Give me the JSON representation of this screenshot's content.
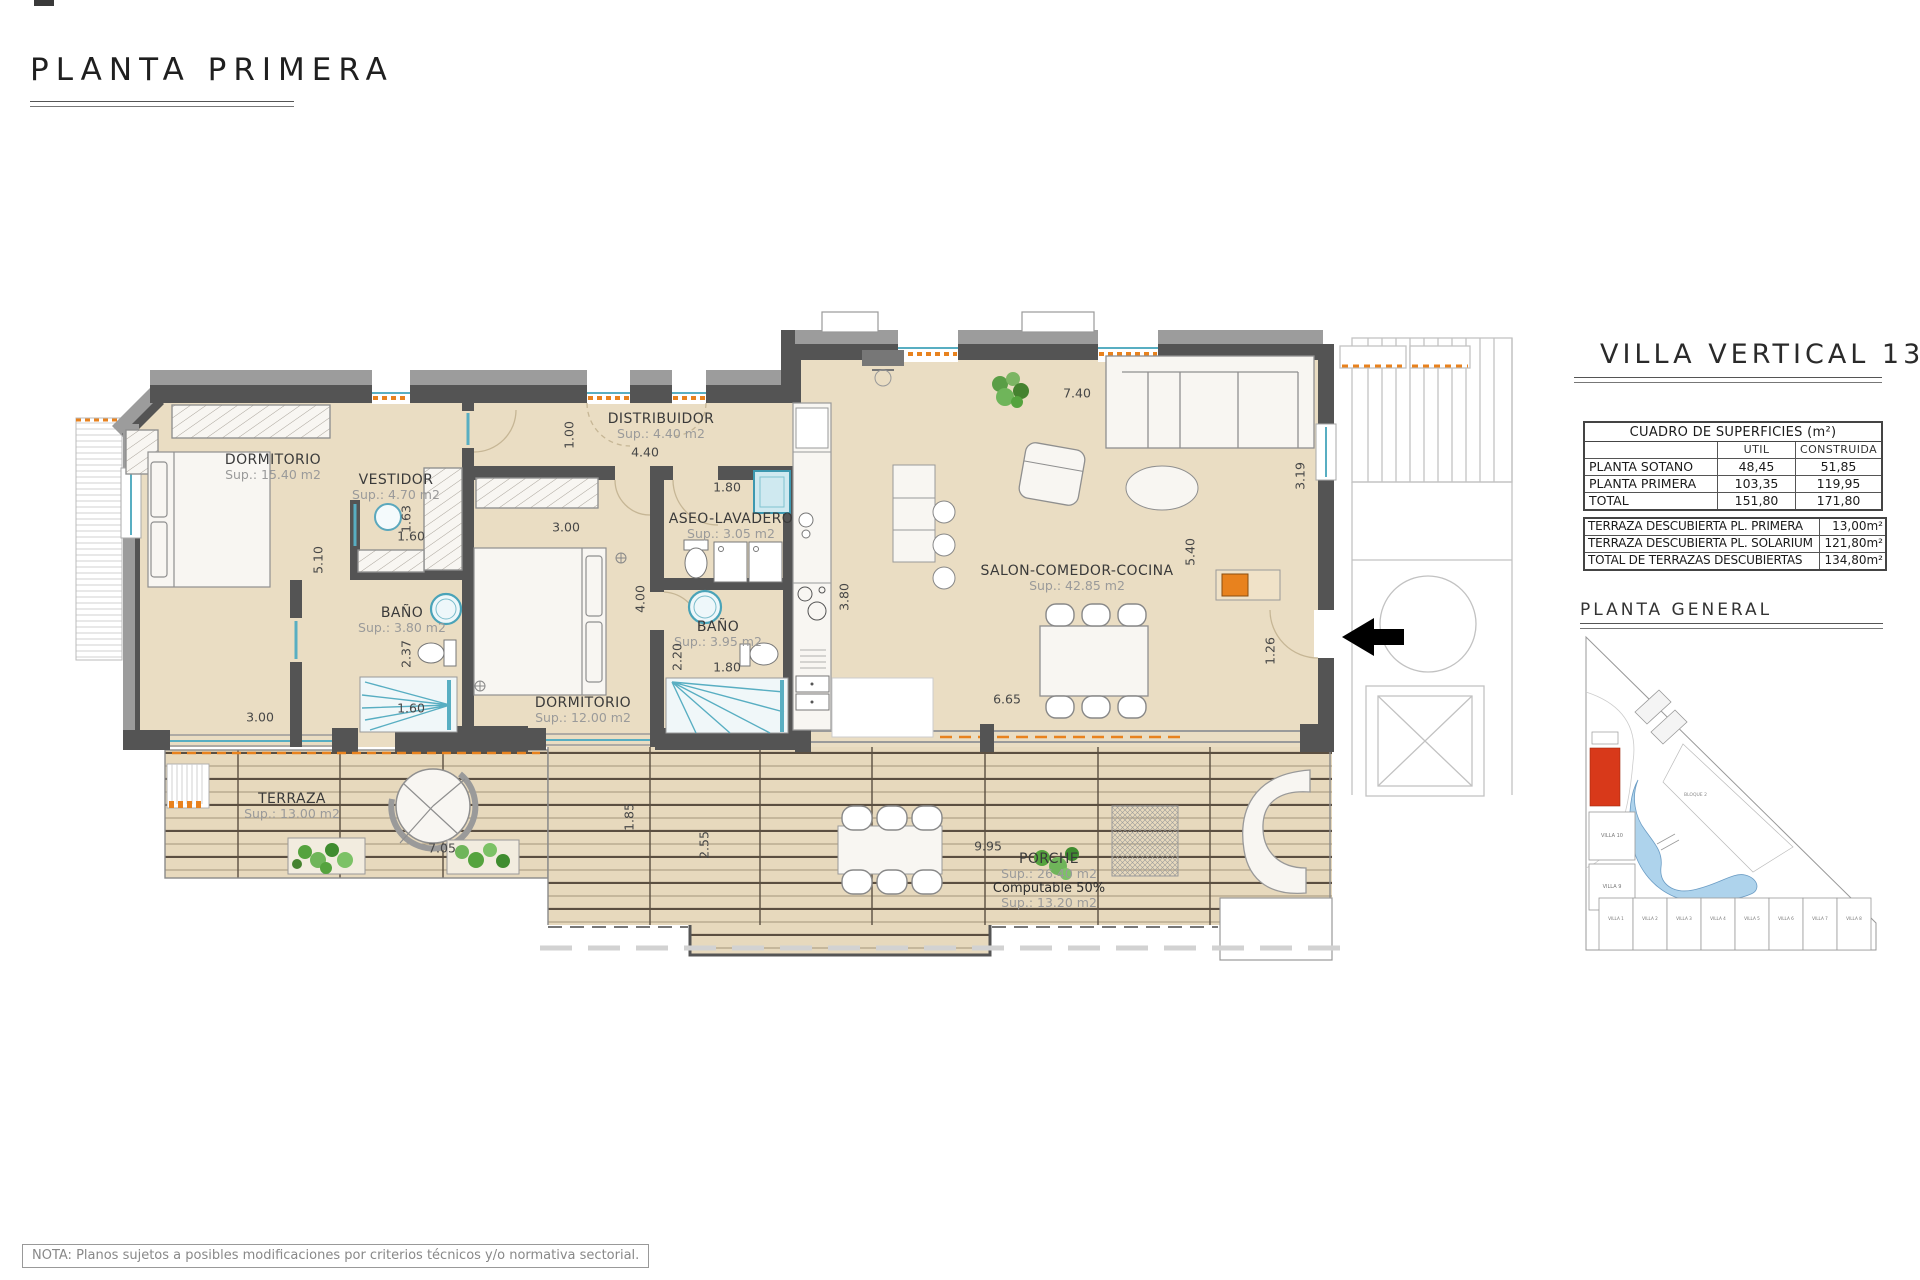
{
  "title": "PLANTA PRIMERA",
  "note": "NOTA: Planos sujetos a posibles modificaciones por criterios técnicos y/o normativa sectorial.",
  "panel": {
    "heading": "VILLA VERTICAL 13",
    "surface_table": {
      "caption": "CUADRO DE SUPERFICIES (m²)",
      "columns": [
        "",
        "UTIL",
        "CONSTRUIDA"
      ],
      "rows": [
        {
          "label": "PLANTA SOTANO",
          "util": "48,45",
          "construida": "51,85"
        },
        {
          "label": "PLANTA PRIMERA",
          "util": "103,35",
          "construida": "119,95"
        },
        {
          "label": "TOTAL",
          "util": "151,80",
          "construida": "171,80"
        }
      ]
    },
    "terrace_table": {
      "rows": [
        {
          "label": "TERRAZA DESCUBIERTA PL. PRIMERA",
          "value": "13,00m²"
        },
        {
          "label": "TERRAZA DESCUBIERTA PL. SOLARIUM",
          "value": "121,80m²"
        },
        {
          "label": "TOTAL DE TERRAZAS DESCUBIERTAS",
          "value": "134,80m²"
        }
      ]
    },
    "site_plan": {
      "heading": "PLANTA GENERAL",
      "block_label": "BLOQUE 2",
      "villas_row": [
        "VILLA 1",
        "VILLA 2",
        "VILLA 3",
        "VILLA 4",
        "VILLA 5",
        "VILLA 6",
        "VILLA 7",
        "VILLA 8"
      ],
      "villas_left": [
        "VILLA 10",
        "VILLA 9"
      ]
    }
  },
  "plan": {
    "rooms": [
      {
        "name": "DORMITORIO",
        "sup": "Sup.: 15.40  m2"
      },
      {
        "name": "VESTIDOR",
        "sup": "Sup.: 4.70  m2"
      },
      {
        "name": "DISTRIBUIDOR",
        "sup": "Sup.: 4.40   m2"
      },
      {
        "name": "ASEO-LAVADERO",
        "sup": "Sup.: 3.05   m2"
      },
      {
        "name": "BAÑO",
        "sup": "Sup.: 3.80   m2"
      },
      {
        "name": "BAÑO",
        "sup": "Sup.: 3.95   m2"
      },
      {
        "name": "DORMITORIO",
        "sup": "Sup.: 12.00  m2"
      },
      {
        "name": "SALON-COMEDOR-COCINA",
        "sup": "Sup.: 42.85  m2"
      },
      {
        "name": "TERRAZA",
        "sup": "Sup.: 13.00  m2"
      },
      {
        "name": "PORCHE",
        "sup": "Sup.: 26.40  m2",
        "note1": "Computable 50%",
        "note2": "Sup.: 13.20  m2"
      }
    ],
    "dims": [
      "1.00",
      "4.40",
      "1.80",
      "7.40",
      "5.10",
      "1.63",
      "1.60",
      "3.00",
      "2.37",
      "1.60",
      "3.00",
      "4.00",
      "2.20",
      "1.80",
      "3.80",
      "5.40",
      "3.19",
      "1.26",
      "6.65",
      "7.05",
      "1.85",
      "2.55",
      "9.95"
    ]
  },
  "colors": {
    "floor_beige": "#eaddc3",
    "deck_beige": "#e7d9bd",
    "wall_dark": "#545454",
    "wall_light": "#9c9c9c",
    "fixture_teal": "#4aa3b8",
    "accent_orange": "#e8821e",
    "site_highlight_red": "#d8391a",
    "pool_blue": "#aed3ec",
    "plant_green": "#55a33e"
  }
}
